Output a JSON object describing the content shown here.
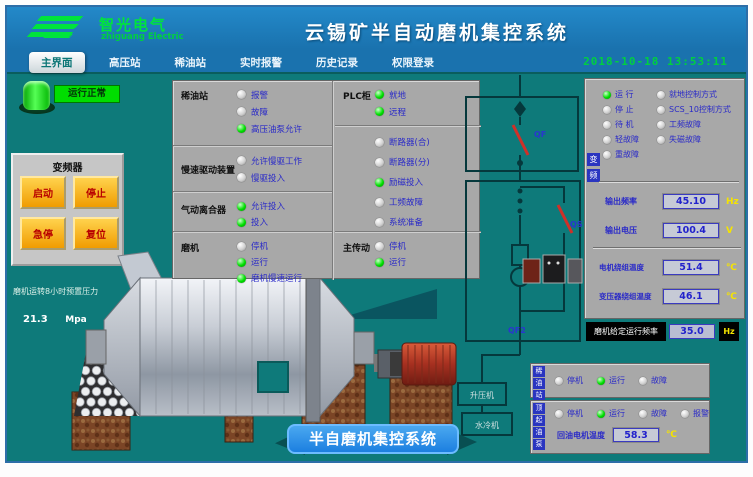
{
  "colors": {
    "header_blue": "#1b7cbd",
    "main_teal": "#0e7a7a",
    "panel_grey": "#a8a8a8",
    "led_green": "#00e000",
    "button_orange": "#f5a623",
    "item_text_blue": "#2a2ac8",
    "run_label_green": "#00dd00",
    "unit_yellow": "#f5e400",
    "datetime_green": "#00d040"
  },
  "header": {
    "logo_title": "智光电气",
    "logo_subtitle": "zhiguang Electric",
    "title": "云锡矿半自动磨机集控系统"
  },
  "menu": {
    "active": "主界面",
    "items": [
      "高压站",
      "稀油站",
      "实时报警",
      "历史记录",
      "权限登录"
    ],
    "datetime": "2018-10-18 13:53:11"
  },
  "left_panel": {
    "run_lamp_label": "运行正常",
    "inverter_box": {
      "title": "变频器",
      "buttons": [
        "启动",
        "停止",
        "急停",
        "复位"
      ]
    },
    "pressure": {
      "label": "磨机运转8小时预置压力",
      "value": "21.3",
      "unit": "Mpa"
    }
  },
  "status_panel": {
    "left_groups": [
      {
        "title": "稀油站",
        "items": [
          {
            "label": "报警",
            "on": false
          },
          {
            "label": "故障",
            "on": false
          },
          {
            "label": "高压油泵允许",
            "on": true
          }
        ]
      },
      {
        "title": "慢速驱动装置",
        "items": [
          {
            "label": "允许慢驱工作",
            "on": false
          },
          {
            "label": "慢驱投入",
            "on": false
          }
        ]
      },
      {
        "title": "气动离合器",
        "items": [
          {
            "label": "允许投入",
            "on": true
          },
          {
            "label": "投入",
            "on": true
          }
        ]
      },
      {
        "title": "磨机",
        "items": [
          {
            "label": "停机",
            "on": false
          },
          {
            "label": "运行",
            "on": true
          },
          {
            "label": "磨机慢速运行",
            "on": true
          }
        ]
      }
    ],
    "right_groups": [
      {
        "title": "PLC柜",
        "items": [
          {
            "label": "就地",
            "on": true
          },
          {
            "label": "远程",
            "on": true
          }
        ]
      },
      {
        "title": "",
        "items": [
          {
            "label": "断路器(合)",
            "on": false
          },
          {
            "label": "断路器(分)",
            "on": false
          },
          {
            "label": "励磁投入",
            "on": true
          },
          {
            "label": "工频故障",
            "on": false
          },
          {
            "label": "系统准备",
            "on": false
          }
        ]
      },
      {
        "title": "主传动",
        "items": [
          {
            "label": "停机",
            "on": false
          },
          {
            "label": "运行",
            "on": true
          }
        ]
      }
    ]
  },
  "vfd_panel": {
    "side_label": "变频",
    "status_left": [
      {
        "label": "运 行",
        "on": true
      },
      {
        "label": "停 止",
        "on": false
      },
      {
        "label": "待 机",
        "on": false
      },
      {
        "label": "轻故障",
        "on": false
      },
      {
        "label": "重故障",
        "on": false
      }
    ],
    "status_right": [
      {
        "label": "就地控制方式",
        "on": false
      },
      {
        "label": "SCS_10控制方式",
        "on": false
      },
      {
        "label": "工频故障",
        "on": false
      },
      {
        "label": "失磁故障",
        "on": false
      }
    ],
    "outputs": [
      {
        "label": "输出频率",
        "value": "45.10",
        "unit": "Hz"
      },
      {
        "label": "输出电压",
        "value": "100.4",
        "unit": "V"
      }
    ],
    "temps": [
      {
        "label": "电机绕组温度",
        "value": "51.4",
        "unit": "℃"
      },
      {
        "label": "变压器绕组温度",
        "value": "46.1",
        "unit": "℃"
      }
    ]
  },
  "freq_setpoint": {
    "label": "磨机给定运行频率",
    "value": "35.0",
    "unit": "Hz"
  },
  "bottom_right": {
    "group_a": {
      "side_label": "稀油站",
      "items": [
        {
          "label": "停机",
          "on": false
        },
        {
          "label": "运行",
          "on": true
        },
        {
          "label": "故障",
          "on": false
        }
      ]
    },
    "group_b": {
      "side_label": "顶起油泵",
      "items": [
        {
          "label": "停机",
          "on": false
        },
        {
          "label": "运行",
          "on": true
        },
        {
          "label": "故障",
          "on": false
        },
        {
          "label": "报警",
          "on": false
        }
      ],
      "temp": {
        "label": "回油电机温度",
        "value": "58.3",
        "unit": "℃"
      }
    }
  },
  "diagram": {
    "qf": "QF",
    "qs": "QS",
    "qf2": "QF2",
    "box1": "升压机",
    "box2": "水冷机"
  },
  "badge": {
    "label": "半自磨机集控系统"
  }
}
